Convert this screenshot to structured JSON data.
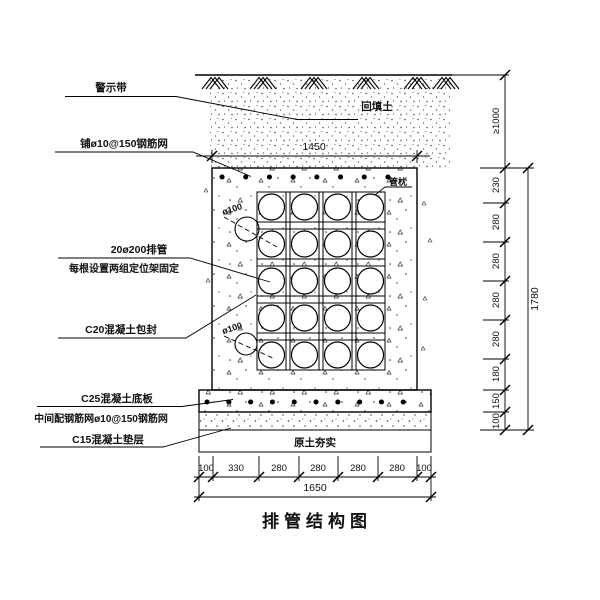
{
  "title": "排管结构图",
  "annotations": {
    "backfill": "回填土",
    "pipe_pillow": "管枕",
    "compacted_soil": "原土夯实",
    "phi100_upper": "ø100",
    "phi100_lower": "ø100"
  },
  "callouts": {
    "warning_tape": "警示带",
    "top_mesh": "铺ø10@150钢筋网",
    "pipes_line1": "20ø200排管",
    "pipes_line2": "每根设置两组定位架固定",
    "encasement": "C20混凝土包封",
    "base_slab_line1": "C25混凝土底板",
    "base_slab_line2": "中间配钢筋网ø10@150钢筋网",
    "cushion": "C15混凝土垫层"
  },
  "dimensions": {
    "top_width": "1450",
    "bottom_segments": [
      "100",
      "330",
      "280",
      "280",
      "280",
      "280",
      "100"
    ],
    "bottom_total": "1650",
    "cover_depth": "≥1000",
    "right_segments": [
      "230",
      "280",
      "280",
      "280",
      "280",
      "180",
      "150",
      "100"
    ],
    "right_total": "1780"
  }
}
